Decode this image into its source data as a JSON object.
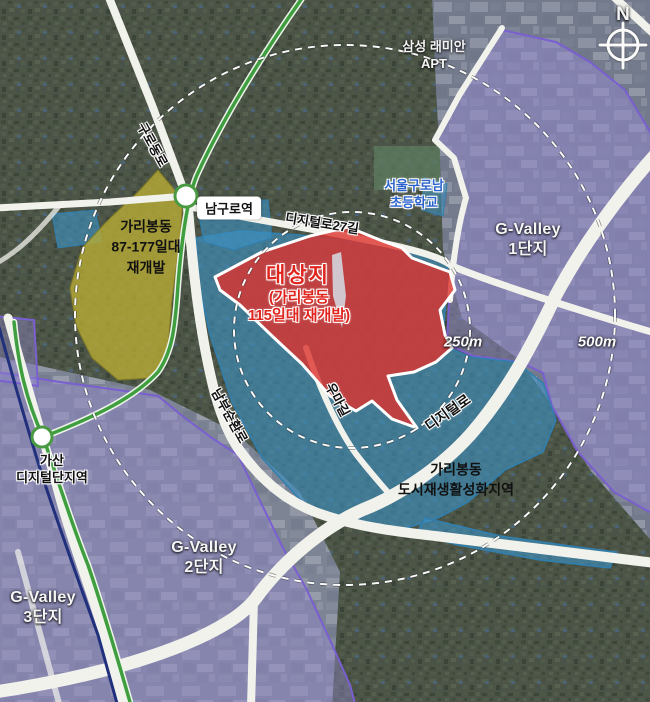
{
  "compass": {
    "north": "N"
  },
  "rings": {
    "inner": "250m",
    "outer": "500m"
  },
  "areas": {
    "target": {
      "name": "대상지",
      "detail": "(가리봉동\n115일대 재개발)",
      "color": "#dd322d"
    },
    "garibong87": {
      "name": "가리봉동\n87-177일대\n재개발",
      "color": "#b8ab35"
    },
    "regen": {
      "name": "가리봉동\n도시재생활성화지역",
      "color": "#3e91c3"
    },
    "gvalley1": {
      "name": "G-Valley\n1단지",
      "color": "#9488d0"
    },
    "gvalley2": {
      "name": "G-Valley\n2단지",
      "color": "#9488d0"
    },
    "gvalley3": {
      "name": "G-Valley\n3단지",
      "color": "#9488d0"
    }
  },
  "stations": {
    "namguro": "남구로역",
    "gasan": "가산\n디지털단지역"
  },
  "roads": {
    "gurodongro": "구로동로",
    "digital27gil": "디지털로27길",
    "digitalro": "디지털로",
    "nambusunhwanro": "남부순환로",
    "umagil": "우마길"
  },
  "places": {
    "samsung_apt": "삼성 래미안\nAPT",
    "school": "서울구로남\n초등학교"
  }
}
